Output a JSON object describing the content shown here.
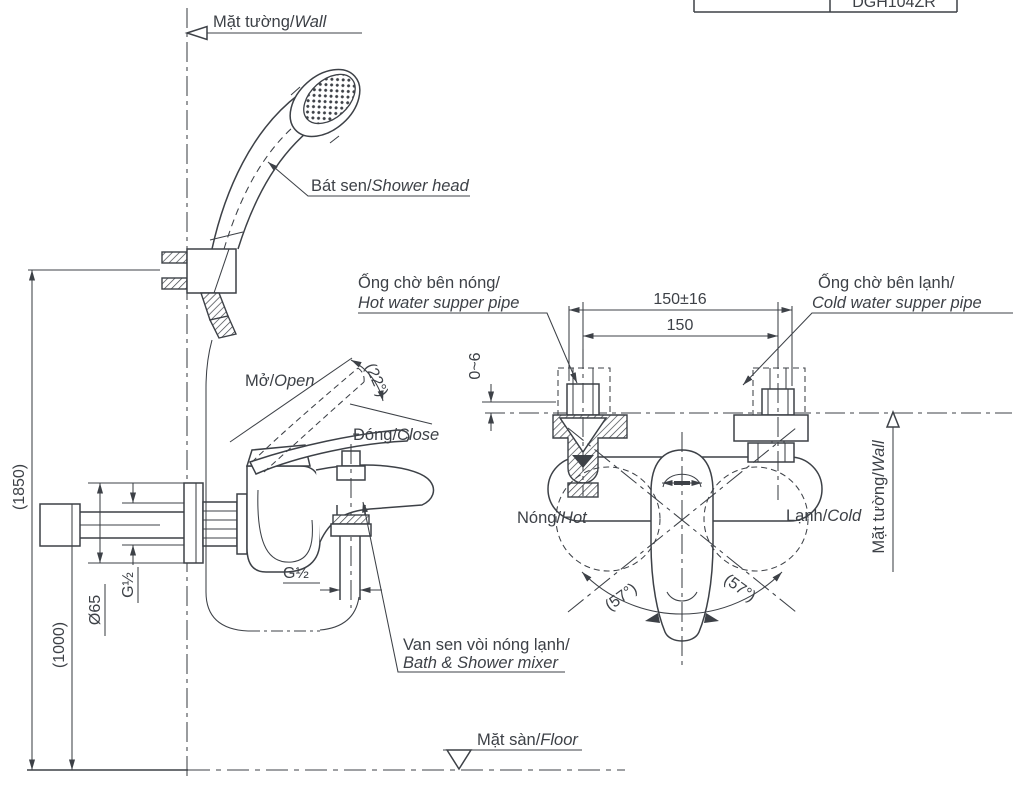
{
  "meta": {
    "ink": "#3d4147",
    "background": "#ffffff"
  },
  "title_block": {
    "code": "DGH104ZR"
  },
  "labels": {
    "wall_top": {
      "vi": "Mặt tường/",
      "en": "Wall"
    },
    "shower_head": {
      "vi": "Bát sen/",
      "en": "Shower head"
    },
    "hot_pipe": {
      "vi": "Ống chờ bên nóng/",
      "en": "Hot water supper pipe"
    },
    "cold_pipe": {
      "vi": "Ống chờ bên lạnh/",
      "en": "Cold water supper pipe"
    },
    "open": {
      "vi": "Mở/",
      "en": "Open"
    },
    "close": {
      "vi": "Đóng/",
      "en": "Close"
    },
    "hot": {
      "vi": "Nóng/",
      "en": "Hot"
    },
    "cold": {
      "vi": "Lạnh/",
      "en": "Cold"
    },
    "wall_right": {
      "vi": "Mặt tường/",
      "en": "Wall"
    },
    "mixer": {
      "vi": "Van sen vòi nóng lạnh/",
      "en": "Bath & Shower mixer"
    },
    "floor": {
      "vi": "Mặt sàn/",
      "en": "Floor"
    }
  },
  "dimensions": {
    "span_tolerance": "150±16",
    "span": "150",
    "wall_gap": "0~6",
    "open_angle": "(22°)",
    "swing_left": "(57°)",
    "swing_right": "(57°)",
    "shower_height": "(1850)",
    "mixer_height": "(1000)",
    "plate_diameter": "Ø65",
    "wall_thread": "G½",
    "spout_thread": "G½"
  }
}
